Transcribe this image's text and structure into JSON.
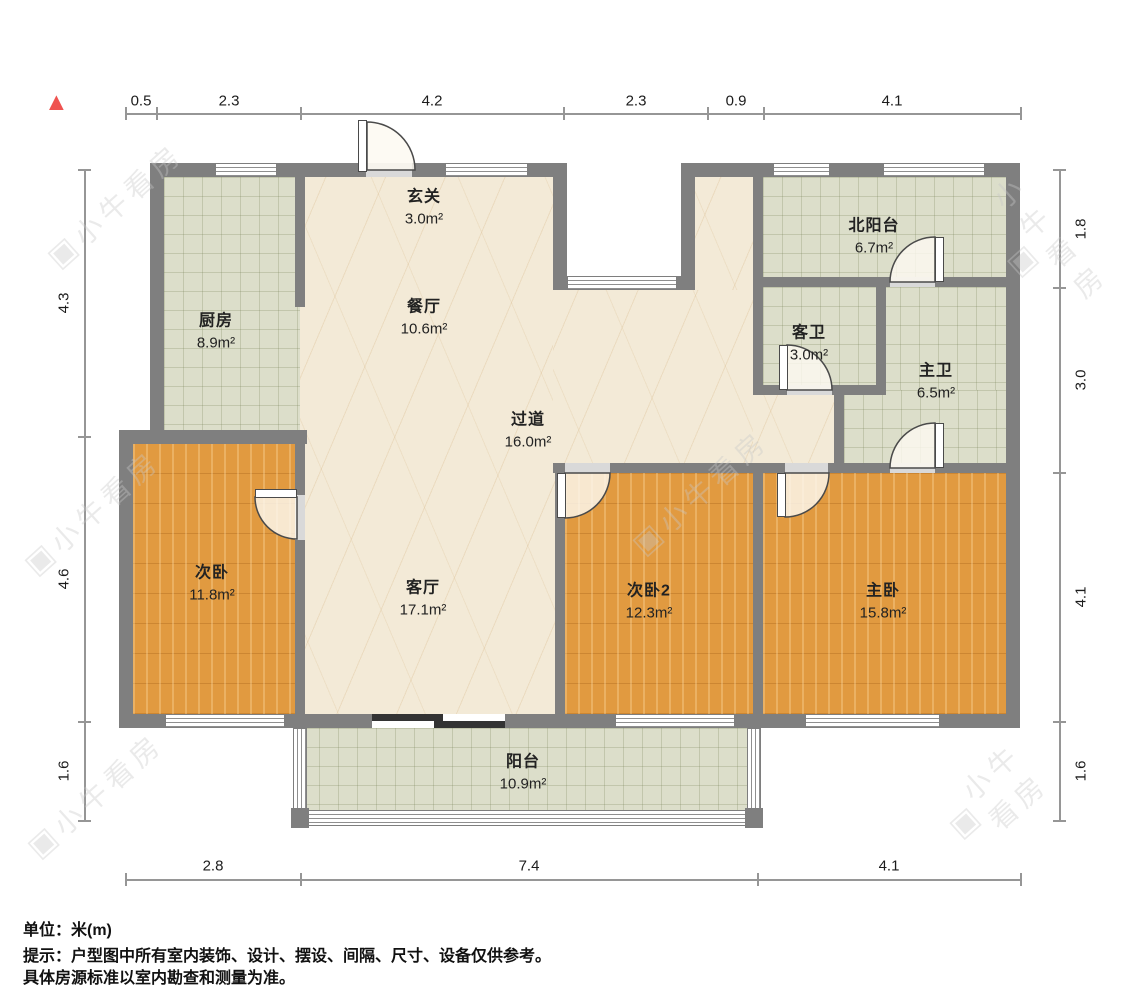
{
  "icons": {
    "north_arrow": "▲",
    "watermark_logo": "▣"
  },
  "watermark": {
    "text": "小牛看房"
  },
  "rooms": [
    {
      "id": "entry",
      "name": "玄关",
      "area": "3.0m²"
    },
    {
      "id": "kitchen",
      "name": "厨房",
      "area": "8.9m²"
    },
    {
      "id": "dining",
      "name": "餐厅",
      "area": "10.6m²"
    },
    {
      "id": "north-balcony",
      "name": "北阳台",
      "area": "6.7m²"
    },
    {
      "id": "guest-bath",
      "name": "客卫",
      "area": "3.0m²"
    },
    {
      "id": "master-bath",
      "name": "主卫",
      "area": "6.5m²"
    },
    {
      "id": "hallway",
      "name": "过道",
      "area": "16.0m²"
    },
    {
      "id": "bedroom-2",
      "name": "次卧",
      "area": "11.8m²"
    },
    {
      "id": "living",
      "name": "客厅",
      "area": "17.1m²"
    },
    {
      "id": "bedroom-3",
      "name": "次卧2",
      "area": "12.3m²"
    },
    {
      "id": "master-bedroom",
      "name": "主卧",
      "area": "15.8m²"
    },
    {
      "id": "balcony",
      "name": "阳台",
      "area": "10.9m²"
    }
  ],
  "dimensions": {
    "unit": "m",
    "top": [
      "0.5",
      "2.3",
      "4.2",
      "2.3",
      "0.9",
      "4.1"
    ],
    "bottom": [
      "2.8",
      "7.4",
      "4.1"
    ],
    "left": [
      "4.3",
      "4.6",
      "1.6"
    ],
    "right": [
      "1.8",
      "3.0",
      "4.1",
      "1.6"
    ]
  },
  "footnotes": {
    "unit": "单位：米(m)",
    "tip": "提示：户型图中所有室内装饰、设计、摆设、间隔、尺寸、设备仅供参考。",
    "tip2": "具体房源标准以室内勘查和测量为准。"
  },
  "colors": {
    "wall": "#7f7f7f",
    "wood": "#e19a40",
    "tile": "#dcdeca",
    "marble": "#f3ead7",
    "accent_north": "#ef5350",
    "dim_text": "#1c1c1c",
    "door": "#4a4a4a"
  }
}
